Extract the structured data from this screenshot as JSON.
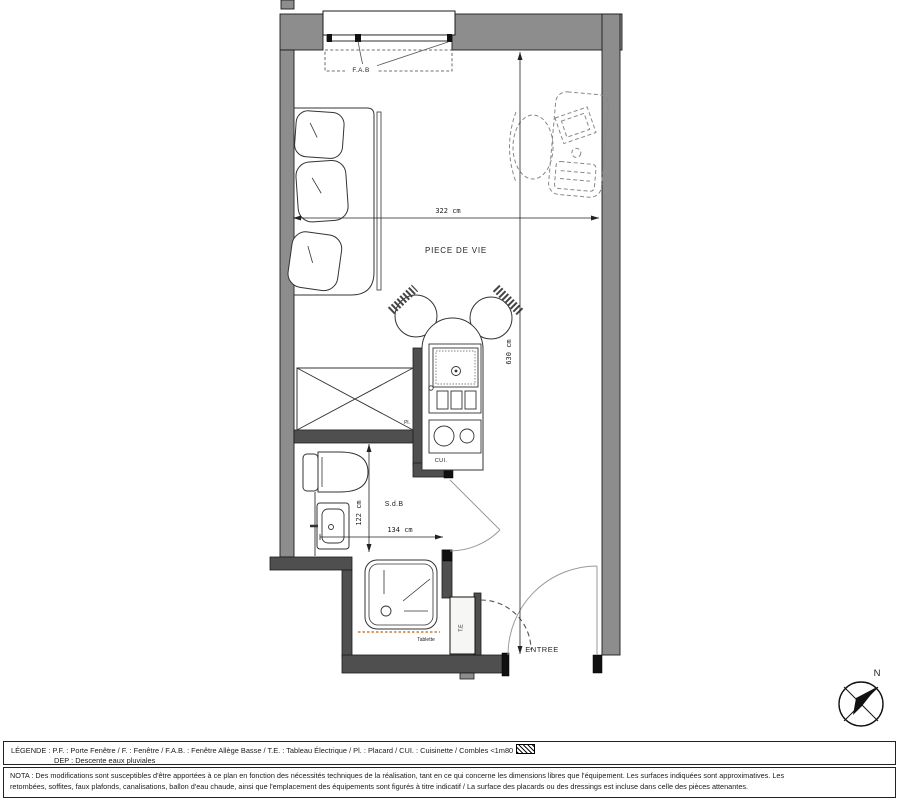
{
  "plan": {
    "room_labels": {
      "living": "PIECE DE VIE",
      "bathroom": "S.d.B",
      "kitchen": "CUI.",
      "closet": "Pl.",
      "entry": "ENTREE",
      "window": "F.A.B",
      "electrical_panel": "T.E",
      "shelf": "Tablette",
      "north": "N"
    },
    "dimensions": {
      "living_width": "322 cm",
      "total_height": "630 cm",
      "bathroom_height": "122 cm",
      "bathroom_width": "134 cm"
    },
    "colors": {
      "outer_wall": "#8d8d8d",
      "inner_wall": "#4f4f4f",
      "jamb": "#111111",
      "line": "#2a2a2a",
      "door_swing": "#9a9a9a",
      "shelf_dotted": "#c87c3c"
    }
  },
  "legend": {
    "line1": "LÉGENDE : P.F. : Porte Fenêtre / F. : Fenêtre / F.A.B. : Fenêtre Allège Basse / T.E. : Tableau Électrique / Pl. : Placard / CUI. : Cuisinette / Combles <1m80",
    "line2": "DEP : Descente eaux pluviales"
  },
  "nota": {
    "line1": "NOTA : Des modifications sont susceptibles d'être apportées à ce plan en fonction des nécessités techniques de la réalisation, tant en ce qui concerne les dimensions libres que l'équipement. Les surfaces indiquées sont approximatives. Les",
    "line2": "retombées, soffites, faux plafonds, canalisations, ballon d'eau chaude, ainsi que l'emplacement des équipements sont figurés à titre indicatif / La surface des placards ou des dressings est incluse dans celle des pièces attenantes."
  }
}
